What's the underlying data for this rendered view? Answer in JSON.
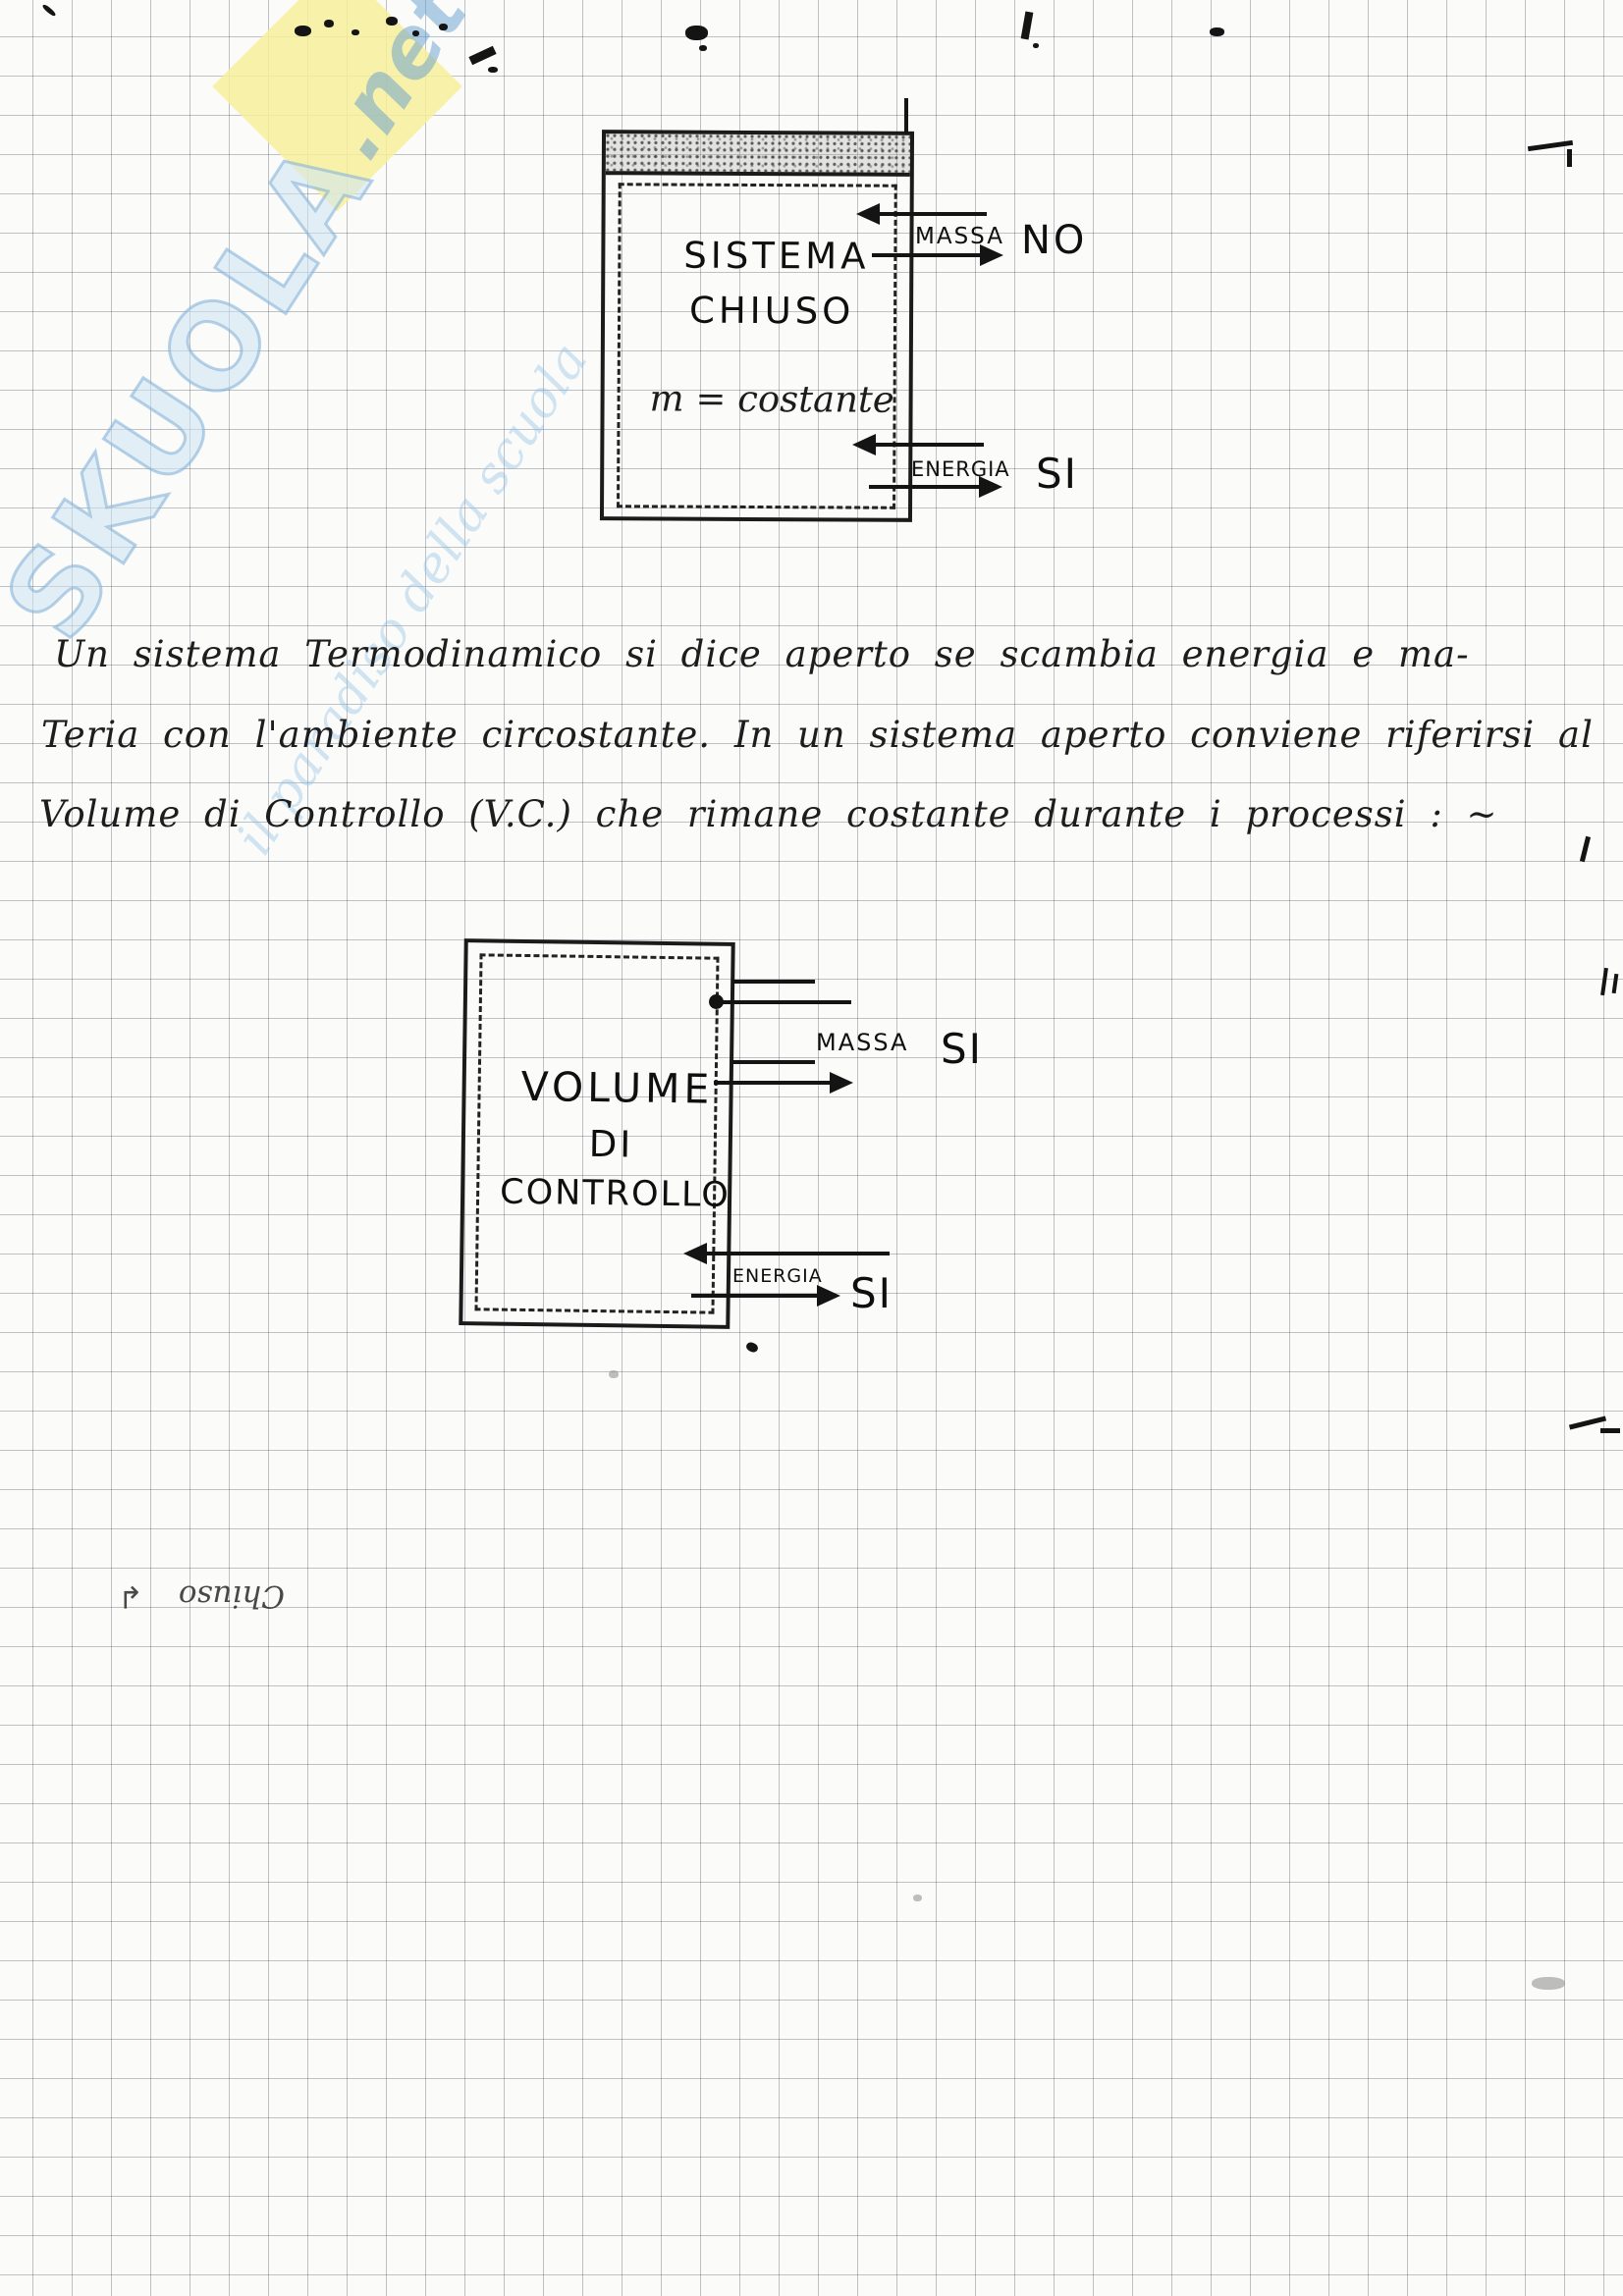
{
  "watermark": {
    "brand": "SKUOLA",
    "suffix": ".net",
    "tagline": "il paradiso della scuola",
    "brand_color": "#7dafd7",
    "diamond_color": "#f7ee9b"
  },
  "diagram_closed_system": {
    "title_line1": "SISTEMA",
    "title_line2": "CHIUSO",
    "equation": "m = costante",
    "mass_label": "MASSA",
    "mass_answer": "NO",
    "energy_label": "ENERGIA",
    "energy_answer": "SI"
  },
  "paragraph": {
    "lines": [
      "Un sistema Termodinamico si dice aperto se scambia energia e ma-",
      "Teria con l'ambiente circostante. In un sistema aperto conviene riferirsi al",
      "Volume di Controllo (V.C.) che rimane costante durante i processi : ~"
    ]
  },
  "diagram_control_volume": {
    "title_line1": "VOLUME",
    "title_line2": "DI",
    "title_line3": "CONTROLLO",
    "mass_label": "MASSA",
    "mass_answer": "SI",
    "energy_label": "ENERGIA",
    "energy_answer": "SI"
  },
  "bleed_through": {
    "arrow_icon": "↲",
    "text": "Chiuso"
  },
  "colors": {
    "ink": "#1a1a1a",
    "grid": "#9aa4b5",
    "paper": "#fbfbf9"
  }
}
